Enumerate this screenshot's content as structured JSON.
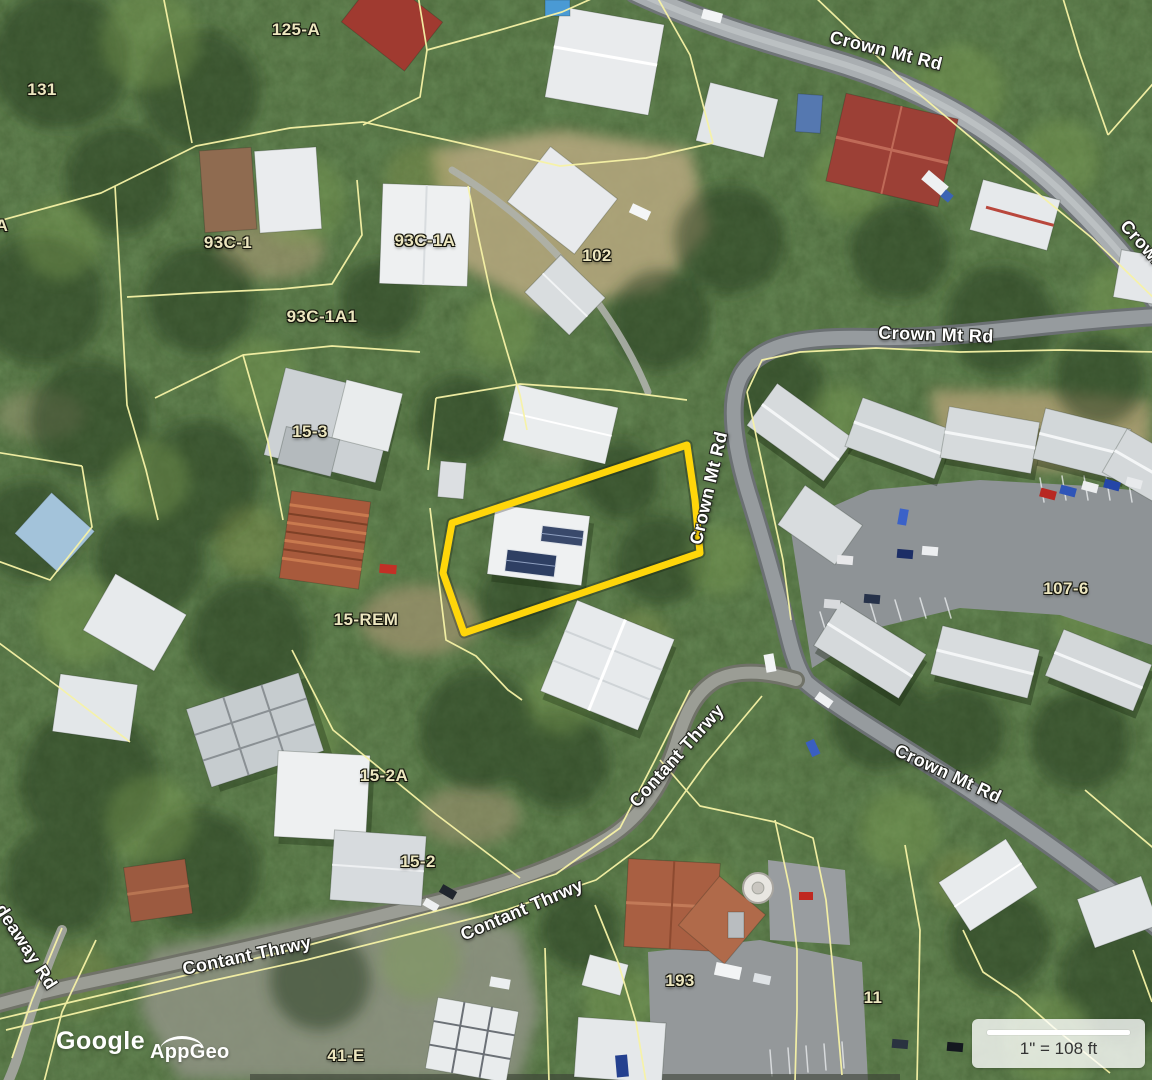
{
  "map": {
    "type": "aerial-parcel-viewer",
    "colors": {
      "highlight_parcel": "#FFD60A",
      "parcel_line": "#F7F3A6",
      "parcel_label": "#ECE6BF",
      "road_label": "#FFFFFF"
    },
    "parcel_labels": [
      {
        "text": "131"
      },
      {
        "text": "125-A"
      },
      {
        "text": "A"
      },
      {
        "text": "93C-1"
      },
      {
        "text": "93C-1A"
      },
      {
        "text": "102"
      },
      {
        "text": "93C-1A1"
      },
      {
        "text": "15-3"
      },
      {
        "text": "15-REM"
      },
      {
        "text": "107-6"
      },
      {
        "text": "15-2A"
      },
      {
        "text": "15-2"
      },
      {
        "text": "193"
      },
      {
        "text": "11"
      },
      {
        "text": "41-E"
      }
    ],
    "road_labels": [
      {
        "text": "Crown Mt Rd"
      },
      {
        "text": "Crown Mt Rd"
      },
      {
        "text": "Crown Mt Rd"
      },
      {
        "text": "Crown Mt Rd"
      },
      {
        "text": "Crown Mt Rd"
      },
      {
        "text": "Contant Thrwy"
      },
      {
        "text": "Contant Thrwy"
      },
      {
        "text": "Contant Thrwy"
      },
      {
        "text": "deaway Rd"
      }
    ],
    "scale_bar": {
      "text": "1\" = 108 ft"
    },
    "attribution": {
      "provider": "Google",
      "app": "AppGeo"
    }
  }
}
